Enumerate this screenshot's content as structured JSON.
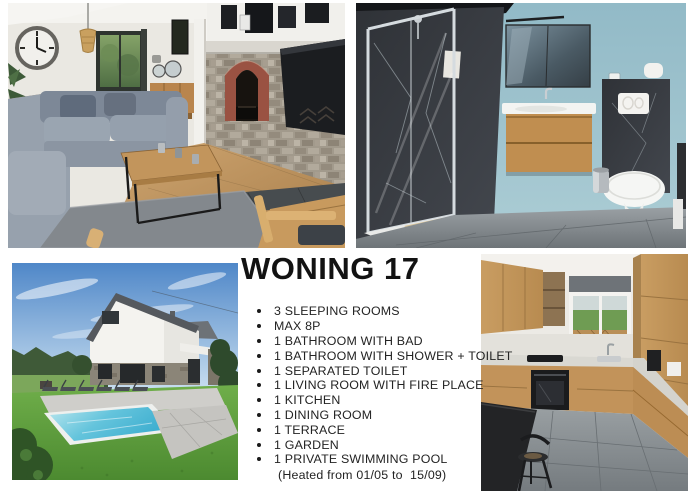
{
  "title": "WONING 17",
  "features": {
    "items": [
      "3 SLEEPING ROOMS",
      "MAX 8P",
      "1 BATHROOM WITH BAD",
      "1 BATHROOM WITH SHOWER + TOILET",
      "1 SEPARATED TOILET",
      "1 LIVING ROOM WITH FIRE PLACE",
      "1 KITCHEN",
      "1 DINING ROOM",
      "1 TERRACE",
      "1 GARDEN",
      "1 PRIVATE SWIMMING POOL"
    ],
    "note": "(Heated from 01/05 to  15/09)"
  },
  "colors": {
    "page_background": "#ffffff",
    "text": "#1a1a1a",
    "bathroom_wall_blue": "#a3c6d1",
    "pool_water_blue": "#55bcd8",
    "oak_wood": "#c79a5e",
    "sofa_gray": "#8e99a7"
  }
}
